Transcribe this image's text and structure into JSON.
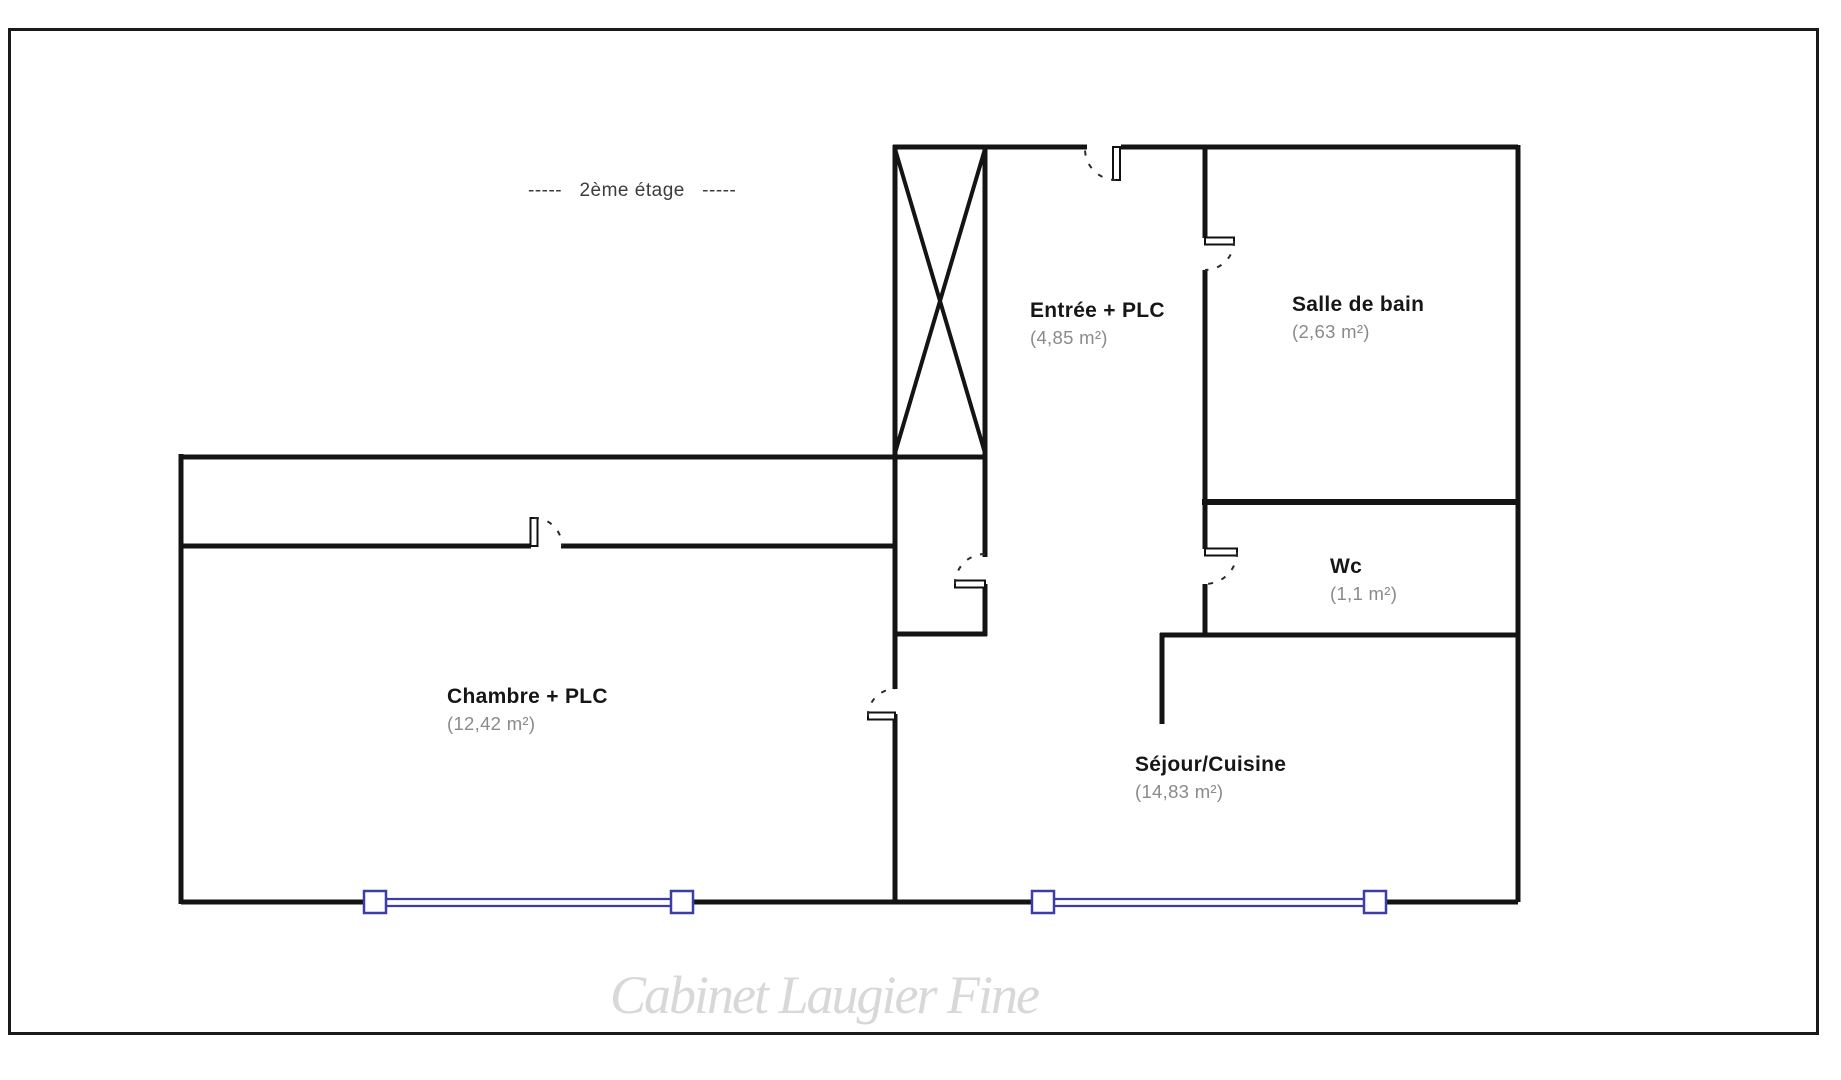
{
  "title": "-----   2ème étage   -----",
  "watermark": {
    "text": "Cabinet Laugier Fine"
  },
  "rooms": [
    {
      "name": "Entrée + PLC",
      "area": "(4,85 m²)"
    },
    {
      "name": "Salle de bain",
      "area": "(2,63 m²)"
    },
    {
      "name": "Wc",
      "area": "(1,1 m²)"
    },
    {
      "name": "Chambre + PLC",
      "area": "(12,42 m²)"
    },
    {
      "name": "Séjour/Cuisine",
      "area": "(14,83 m²)"
    }
  ],
  "colors": {
    "wall": "#141414",
    "window_frame": "#3d3da6",
    "area_text": "#8a8a8a",
    "watermark_text": "#d8d8d8"
  }
}
